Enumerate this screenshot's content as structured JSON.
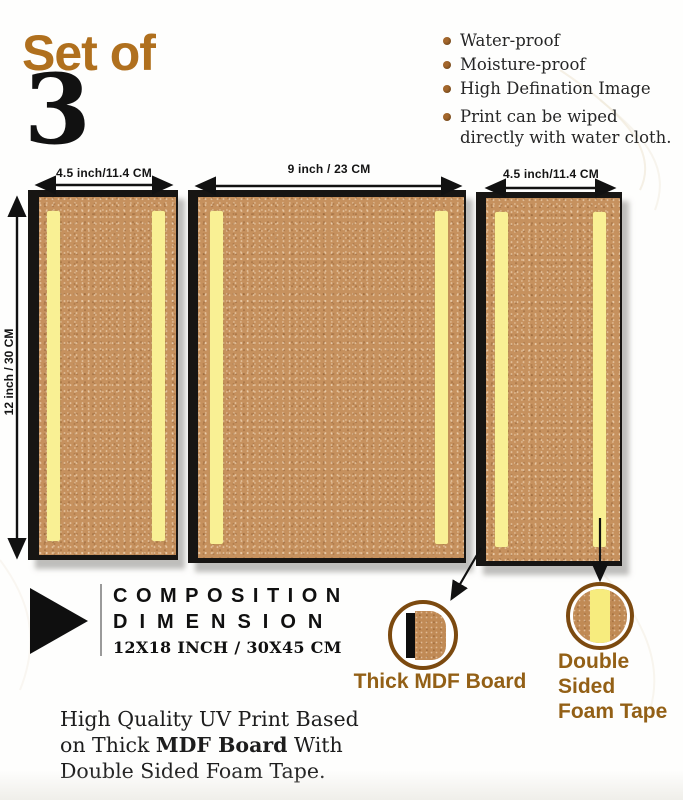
{
  "header": {
    "set_of": "Set of",
    "count": "3"
  },
  "features": {
    "items": [
      {
        "label": "Water-proof"
      },
      {
        "label": "Moisture-proof"
      },
      {
        "label": "High Defination Image"
      },
      {
        "label": "Print can be wiped directly with water cloth."
      }
    ]
  },
  "boards": {
    "height_label": "12 inch / 30 CM",
    "left": {
      "width_label": "4.5 inch/11.4 CM"
    },
    "middle": {
      "width_label": "9 inch / 23 CM"
    },
    "right": {
      "width_label": "4.5 inch/11.4 CM"
    }
  },
  "composition": {
    "line1": "COMPOSITION",
    "line2": "DIMENSION",
    "size": "12X18 INCH / 30X45 CM"
  },
  "callouts": {
    "mdf": {
      "label": "Thick MDF Board"
    },
    "tape": {
      "label_line1": "Double Sided",
      "label_line2": "Foam Tape"
    }
  },
  "footer": {
    "line1": "High Quality UV Print Based",
    "line2_pre": "on Thick ",
    "line2_bold": "MDF Board",
    "line2_post": " With",
    "line3": "Double Sided Foam Tape."
  },
  "colors": {
    "accent_brown": "#b0701e",
    "label_brown": "#936016",
    "board_tan": "#c6915e",
    "tape_yellow": "#f9f094",
    "edge_black": "#171513"
  }
}
